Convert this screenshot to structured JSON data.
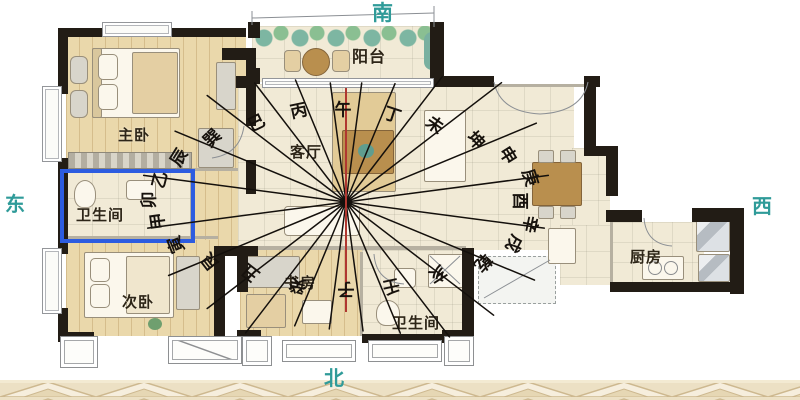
{
  "directions": {
    "south": "南",
    "north": "北",
    "east": "东",
    "west": "西"
  },
  "rooms": {
    "master_bedroom": "主卧",
    "bathroom_left": "卫生间",
    "second_bedroom": "次卧",
    "balcony": "阳台",
    "living_room": "客厅",
    "study": "书房",
    "bathroom_bottom": "卫生间",
    "kitchen": "厨房"
  },
  "colors": {
    "direction_text": "#2f9b99",
    "highlight_box": "#2d5ce0",
    "compass_ray": "#14100c",
    "meridian_red": "#b03730"
  },
  "compass": {
    "center": {
      "x": 346,
      "y": 202
    },
    "ray_color": "#14100c",
    "meridian_color": "#b03730",
    "meridian": {
      "y1": 88,
      "y2": 312
    },
    "rays": [
      {
        "az": 7.5,
        "len": 120
      },
      {
        "az": 22.5,
        "len": 128
      },
      {
        "az": 37.5,
        "len": 158
      },
      {
        "az": 52.5,
        "len": 196
      },
      {
        "az": 67.5,
        "len": 206
      },
      {
        "az": 82.5,
        "len": 204
      },
      {
        "az": 97.5,
        "len": 200
      },
      {
        "az": 112.5,
        "len": 204
      },
      {
        "az": 127.5,
        "len": 186
      },
      {
        "az": 142.5,
        "len": 170
      },
      {
        "az": 157.5,
        "len": 142
      },
      {
        "az": 172.5,
        "len": 130
      },
      {
        "az": 187.5,
        "len": 128
      },
      {
        "az": 202.5,
        "len": 134
      },
      {
        "az": 217.5,
        "len": 165
      },
      {
        "az": 232.5,
        "len": 175
      },
      {
        "az": 247.5,
        "len": 192
      },
      {
        "az": 262.5,
        "len": 200
      },
      {
        "az": 277.5,
        "len": 204
      },
      {
        "az": 292.5,
        "len": 185
      },
      {
        "az": 307.5,
        "len": 175
      },
      {
        "az": 322.5,
        "len": 150
      },
      {
        "az": 337.5,
        "len": 132
      },
      {
        "az": 352.5,
        "len": 120
      }
    ],
    "mountains": [
      {
        "label": "午",
        "x": 343,
        "y": 111,
        "rot": 0
      },
      {
        "label": "丁",
        "x": 392,
        "y": 116,
        "rot": 18
      },
      {
        "label": "未",
        "x": 434,
        "y": 126,
        "rot": 35
      },
      {
        "label": "坤",
        "x": 475,
        "y": 141,
        "rot": 48
      },
      {
        "label": "申",
        "x": 507,
        "y": 156,
        "rot": 58
      },
      {
        "label": "庚",
        "x": 529,
        "y": 178,
        "rot": 72
      },
      {
        "label": "酉",
        "x": 519,
        "y": 201,
        "rot": 90
      },
      {
        "label": "辛",
        "x": 529,
        "y": 224,
        "rot": 102
      },
      {
        "label": "戌",
        "x": 513,
        "y": 243,
        "rot": 118
      },
      {
        "label": "乾",
        "x": 482,
        "y": 262,
        "rot": 132
      },
      {
        "label": "亥",
        "x": 437,
        "y": 273,
        "rot": 148
      },
      {
        "label": "壬",
        "x": 391,
        "y": 285,
        "rot": 168
      },
      {
        "label": "子",
        "x": 346,
        "y": 288,
        "rot": 180
      },
      {
        "label": "癸",
        "x": 298,
        "y": 284,
        "rot": -165
      },
      {
        "label": "丑",
        "x": 251,
        "y": 272,
        "rot": -142
      },
      {
        "label": "艮",
        "x": 211,
        "y": 261,
        "rot": -128
      },
      {
        "label": "寅",
        "x": 177,
        "y": 244,
        "rot": -112
      },
      {
        "label": "甲",
        "x": 159,
        "y": 221,
        "rot": -98
      },
      {
        "label": "卯",
        "x": 150,
        "y": 200,
        "rot": -90
      },
      {
        "label": "乙",
        "x": 161,
        "y": 180,
        "rot": -76
      },
      {
        "label": "辰",
        "x": 180,
        "y": 158,
        "rot": -58
      },
      {
        "label": "巽",
        "x": 213,
        "y": 139,
        "rot": -44
      },
      {
        "label": "巳",
        "x": 257,
        "y": 124,
        "rot": -26
      },
      {
        "label": "丙",
        "x": 299,
        "y": 112,
        "rot": -12
      }
    ]
  }
}
